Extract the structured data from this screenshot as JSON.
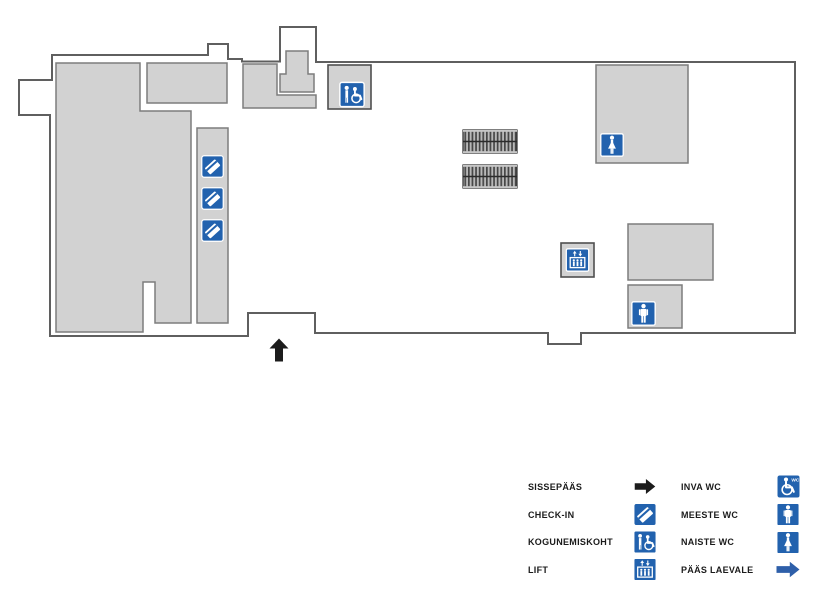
{
  "map": {
    "type": "floor-plan",
    "markers": [
      {
        "name": "kogunemiskoht-marker"
      },
      {
        "name": "check-in-marker-1"
      },
      {
        "name": "check-in-marker-2"
      },
      {
        "name": "check-in-marker-3"
      },
      {
        "name": "naiste-wc-marker"
      },
      {
        "name": "lift-marker"
      },
      {
        "name": "meeste-wc-marker"
      },
      {
        "name": "sissepaas-arrow-marker"
      }
    ],
    "stairs_blocks": 2
  },
  "legend": {
    "left": [
      {
        "label": "SISSEPÄÄS",
        "icon": "entrance-arrow-icon"
      },
      {
        "label": "CHECK-IN",
        "icon": "ticket-icon"
      },
      {
        "label": "KOGUNEMISKOHT",
        "icon": "assembly-point-icon"
      },
      {
        "label": "LIFT",
        "icon": "lift-icon"
      }
    ],
    "right": [
      {
        "label": "INVA WC",
        "icon": "accessible-wc-icon",
        "icon_text": "WC"
      },
      {
        "label": "MEESTE WC",
        "icon": "mens-wc-icon"
      },
      {
        "label": "NAISTE WC",
        "icon": "womens-wc-icon"
      },
      {
        "label": "PÄÄS LAEVALE",
        "icon": "ship-access-arrow-icon"
      }
    ]
  },
  "colors": {
    "icon_blue": "#2262ae",
    "arrow_blue": "#2e5fa9",
    "arrow_black": "#1c1c1c",
    "room_fill": "#d2d2d2",
    "room_border": "#7d7d7d",
    "wall": "#5f5f5f",
    "label_text": "#1b1b1b"
  }
}
